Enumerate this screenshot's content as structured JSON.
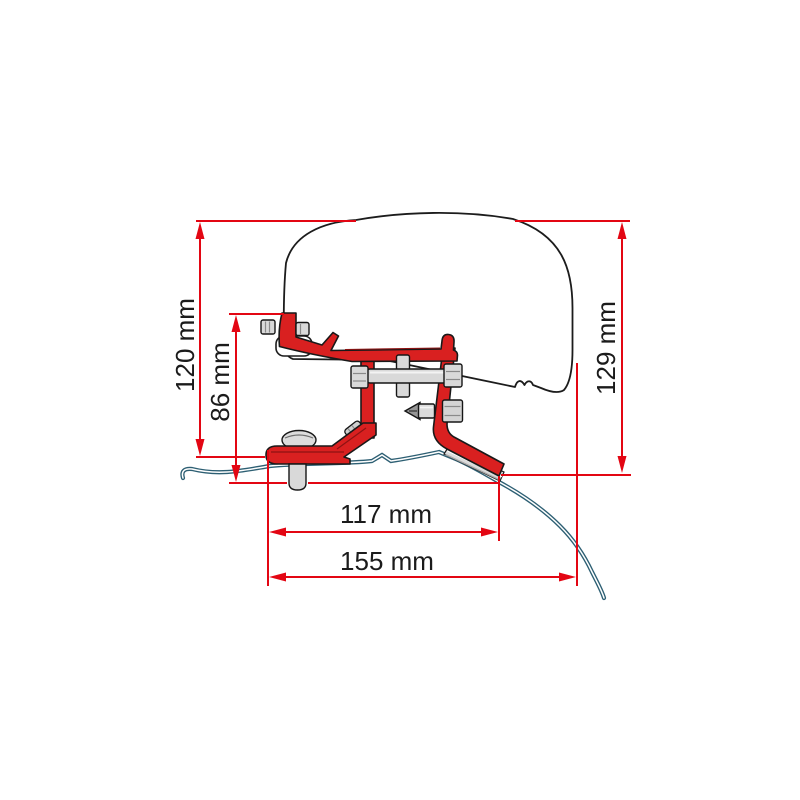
{
  "diagram": {
    "type": "technical-dimension-drawing",
    "subject": "awning adapter bracket mounted on van roof, side section view",
    "dimensions": {
      "d120": {
        "label": "120 mm",
        "value": 120,
        "unit": "mm",
        "orientation": "vertical"
      },
      "d86": {
        "label": "86 mm",
        "value": 86,
        "unit": "mm",
        "orientation": "vertical"
      },
      "d129": {
        "label": "129 mm",
        "value": 129,
        "unit": "mm",
        "orientation": "vertical"
      },
      "d117": {
        "label": "117 mm",
        "value": 117,
        "unit": "mm",
        "orientation": "horizontal"
      },
      "d155": {
        "label": "155 mm",
        "value": 155,
        "unit": "mm",
        "orientation": "horizontal"
      }
    },
    "colors": {
      "dimension_red": "#e30613",
      "bracket_red": "#d92020",
      "roof_line_blue": "#2d5f73",
      "outline_black": "#1c1c1c",
      "metal_gray": "#d9d9d9",
      "background": "#ffffff"
    }
  }
}
